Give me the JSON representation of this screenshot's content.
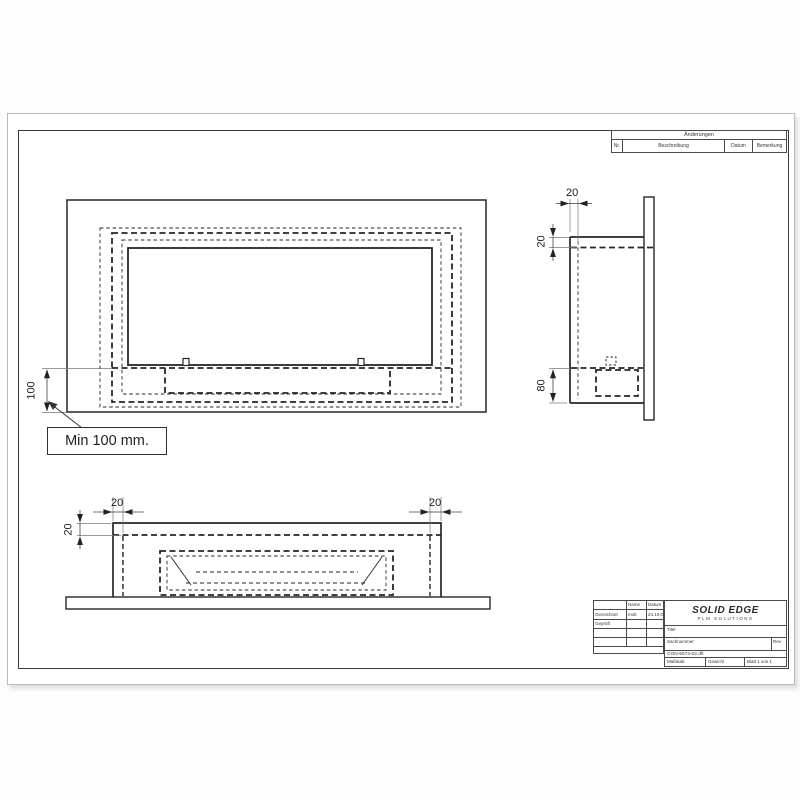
{
  "drawing": {
    "front": {
      "dim_height": "100",
      "callout": "Min 100 mm."
    },
    "side": {
      "dim_depth": "20",
      "dim_top": "20",
      "dim_bottom": "80"
    },
    "top": {
      "dim_left": "20",
      "dim_right": "20",
      "dim_edge": "20"
    }
  },
  "revision_table": {
    "title": "Änderungen",
    "col_nr": "Nr.",
    "col_desc": "Beschreibung",
    "col_date": "Datum",
    "col_note": "Bemerkung"
  },
  "title_block": {
    "col_name": "Name",
    "col_date": "Datum",
    "row1_label": "Gezeichnet",
    "row1_name": "mvb",
    "row1_date": "24.10.07",
    "row2_label": "Geprüft",
    "logo": "SOLID EDGE",
    "logo_sub": "PLM SOLUTIONS",
    "title_label": "Titel",
    "number_label": "Sachnummer:",
    "rev_label": "Rev",
    "filename": "CON-5074-02.dft",
    "scale_label": "Maßstab",
    "weight_label": "Gewicht",
    "sheet_label": "Blatt 1 von 1"
  },
  "colors": {
    "line": "#262626",
    "dim_line": "#555555",
    "paper": "#ffffff"
  }
}
